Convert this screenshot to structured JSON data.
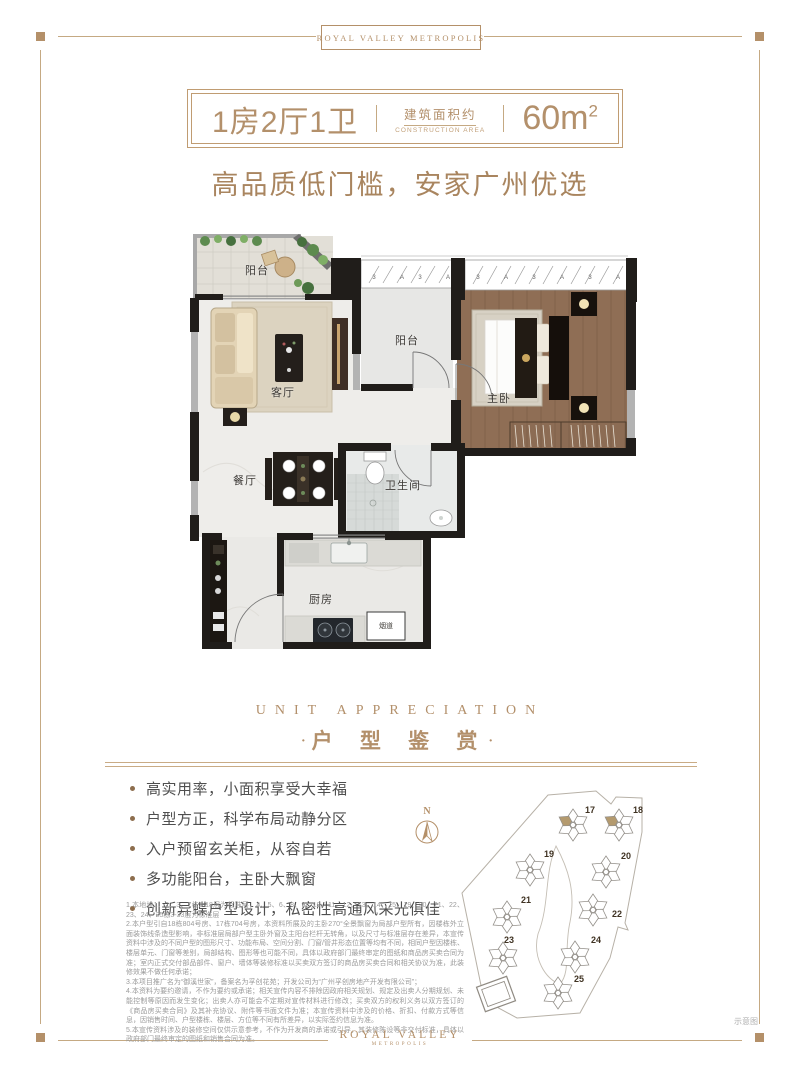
{
  "header": {
    "brand": "ROYAL VALLEY METROPOLIS"
  },
  "title_box": {
    "layout": "1房2厅1卫",
    "area_label_cn": "建筑面积约",
    "area_label_en": "CONSTRUCTION AREA",
    "area_value": "60m",
    "area_unit_sup": "2"
  },
  "subtitle": "高品质低门槛，安家广州优选",
  "floorplan": {
    "rooms": {
      "balcony_top": "阳台",
      "living_room": "客厅",
      "balcony_mid": "阳台",
      "master_bedroom": "主卧",
      "dining_room": "餐厅",
      "bathroom": "卫生间",
      "kitchen": "厨房",
      "flue": "烟道"
    },
    "window_marks": [
      "3",
      "A"
    ]
  },
  "section_header": {
    "en": "UNIT APPRECIATION",
    "cn": "户 型 鉴 赏",
    "dot": "·"
  },
  "features": [
    "高实用率，小面积享受大幸福",
    "户型方正，科学布局动静分区",
    "入户预留玄关柜，从容自若",
    "多功能阳台，主卧大飘窗",
    "创新异蝶户型设计，私密性高通风采光俱佳"
  ],
  "disclaimer": [
    "1.本地块1、2、3、7栋2-18层为标准层，4、5、6、8、9、10、11、12、13、14、15、19、20、21、22、23、24、25栋3-33层为标准层",
    "2.本户型引自18栋804号房、17栋704号房，本资料所展及的主卧270°全景飘窗为局部户型所有，因楼栋外立面装饰线条造型影响，非标准层局部户型主卧外窗及主阳台栏杆无转角，以及尺寸与标准层存在差异，本宣传资料中涉及的不同户型的图形尺寸、功能布局、空间分割、门窗/管井形态位置等均有不同，相同户型因楼栋、楼层单元、门窗等差别，局部结构、图形等也可能不同，具体以政府部门最终审定的图纸和商品房买卖合同为准；室内正式交付部品部件、窗户、墙体等装修标准以买卖双方签订的商品房买卖合同和相关协议为准，此装修效果不做任何承诺；",
    "3.本项目推广名为“御溪世家”，备案名为孚创花苑；开发公司为“广州孚创房地产开发有限公司”；",
    "4.本资料为要约邀请，不作为要约或承诺；相关宣传内容不排除因政府相关规划、规定及出卖人分期规划、未能控制等原因而发生变化；出卖人亦可能会不定期对宣传材料进行修改；买卖双方的权利义务以双方签订的《商品房买卖合同》及其补充协议、附件等书面文件为准；本宣传资料中涉及的价格、折扣、付款方式等信息，因销售时间、户型楼栋、楼层、方位等不同有所差异，以实际签约信息为准。",
    "5.本宣传资料涉及的装修空间仅供示意参考，不作为开发商的承诺或引导，其装修陈设等非交付标准，具体以政府部门最终审定的图纸和销售合同为准。"
  ],
  "site_map": {
    "compass_label": "N",
    "note": "示意图",
    "highlight_color": "#b49a6e",
    "buildings": [
      {
        "no": "17",
        "x": 121,
        "y": 39,
        "lx": 133,
        "ly": 27,
        "highlight": true
      },
      {
        "no": "18",
        "x": 167,
        "y": 39,
        "lx": 181,
        "ly": 27,
        "highlight": true
      },
      {
        "no": "19",
        "x": 78,
        "y": 84,
        "lx": 92,
        "ly": 71,
        "highlight": false
      },
      {
        "no": "20",
        "x": 154,
        "y": 86,
        "lx": 169,
        "ly": 73,
        "highlight": false
      },
      {
        "no": "21",
        "x": 55,
        "y": 131,
        "lx": 69,
        "ly": 117,
        "highlight": false
      },
      {
        "no": "22",
        "x": 141,
        "y": 124,
        "lx": 160,
        "ly": 131,
        "highlight": false
      },
      {
        "no": "23",
        "x": 51,
        "y": 172,
        "lx": 52,
        "ly": 157,
        "highlight": false
      },
      {
        "no": "24",
        "x": 123,
        "y": 171,
        "lx": 139,
        "ly": 157,
        "highlight": false
      },
      {
        "no": "25",
        "x": 106,
        "y": 207,
        "lx": 122,
        "ly": 196,
        "highlight": false
      }
    ]
  },
  "footer": {
    "brand_line1": "ROYAL VALLEY",
    "brand_line2": "METROPOLIS"
  }
}
